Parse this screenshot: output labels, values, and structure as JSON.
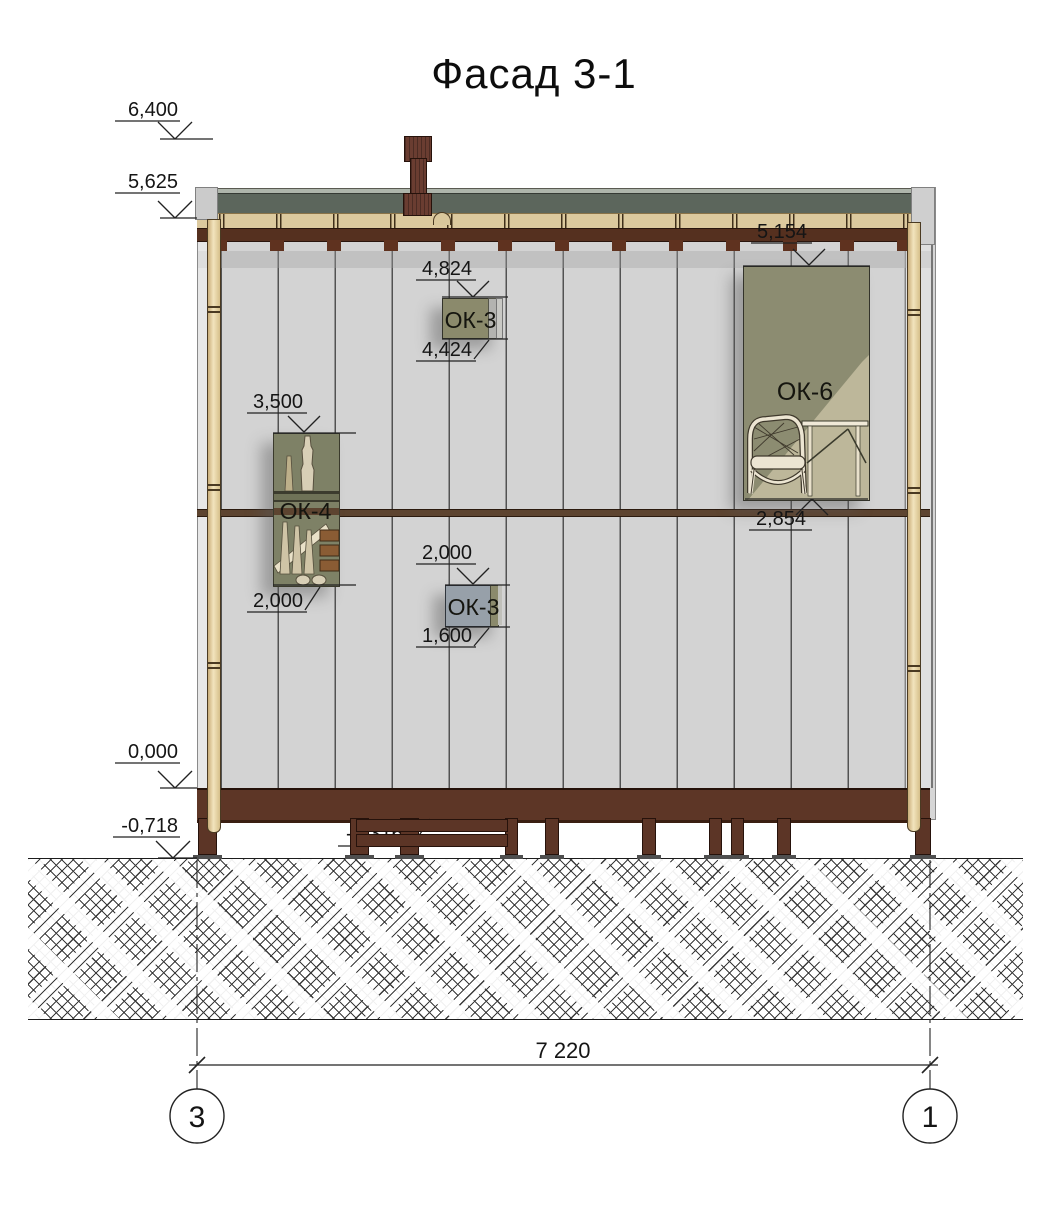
{
  "title": "Фасад 3-1",
  "elevation_marks": {
    "chimney_top": "6,400",
    "eaves": "5,625",
    "floor_zero": "0,000",
    "ground": "-0,718",
    "porch": "-0,316"
  },
  "window_dims": {
    "ok3_upper_top": "4,824",
    "ok3_upper_bottom": "4,424",
    "ok4_top": "3,500",
    "ok4_bottom": "2,000",
    "ok3_lower_top": "2,000",
    "ok3_lower_bottom": "1,600",
    "ok6_top": "5,154",
    "ok6_sill": "2,854"
  },
  "window_labels": {
    "ok4": "ОК-4",
    "ok3_upper": "ОК-3",
    "ok3_lower": "ОК-3",
    "ok6": "ОК-6"
  },
  "grid": {
    "span": "7 220",
    "axis_left": "3",
    "axis_right": "1"
  },
  "colors": {
    "roof_slab": "#5c665c",
    "wall": "#d3d3d3",
    "fascia_dark_brown": "#55301f",
    "eaves_beam": "#dcc99e",
    "log_post": "#e9d8ab",
    "window_olive": "#8c8c71",
    "window_blue_gray": "#97a0a9",
    "foundation_brown": "#5c3526"
  }
}
